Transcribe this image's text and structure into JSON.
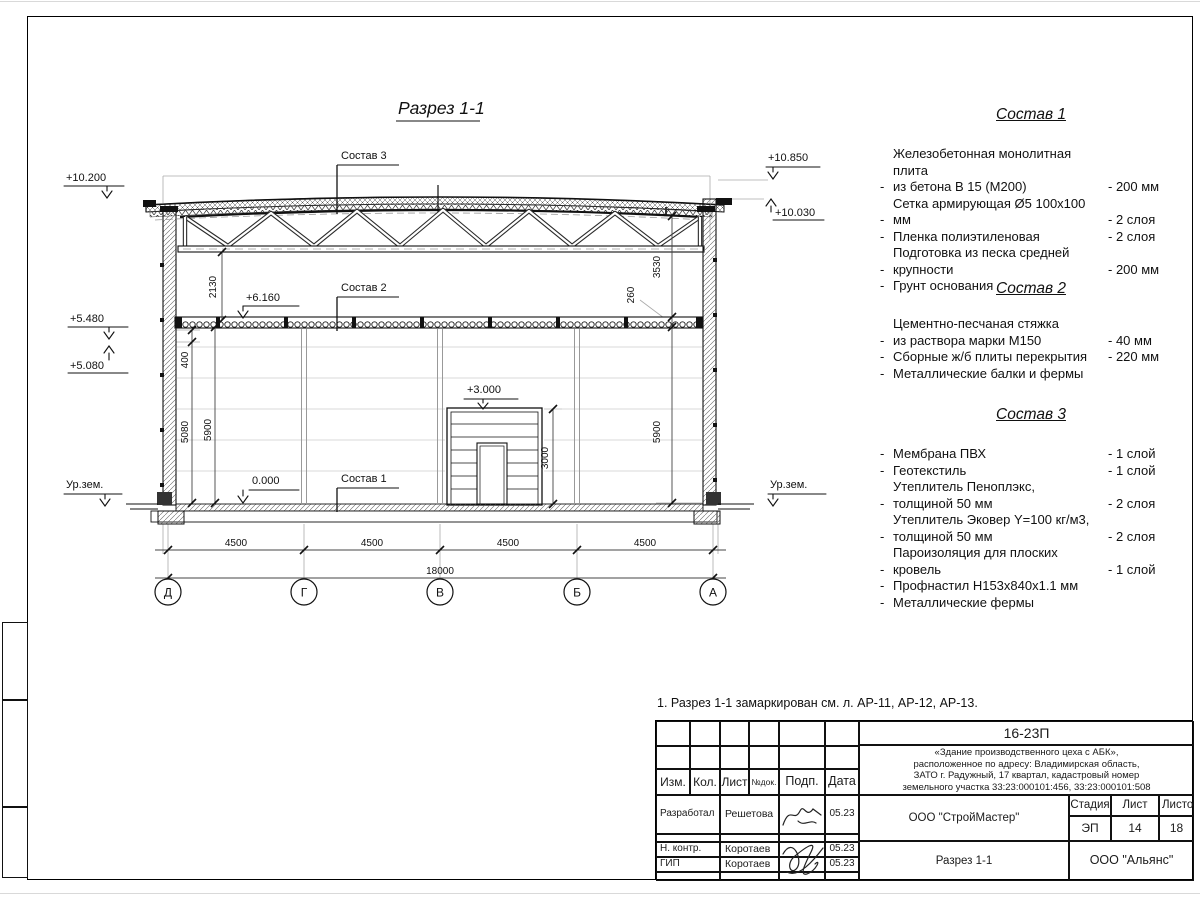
{
  "sheet": {
    "title": "Разрез 1-1",
    "note": "1. Разрез 1-1 замаркирован см. л. АР-11, АР-12, АР-13."
  },
  "drawing": {
    "labels": {
      "sostav1": "Состав 1",
      "sostav2": "Состав 2",
      "sostav3": "Состав 3"
    },
    "elevations": {
      "left_roof": "+10.200",
      "right_parapet": "+10.850",
      "right_roof": "+10.030",
      "left_upper": "+5.480",
      "left_lower": "+5.080",
      "slab": "+6.160",
      "gate": "+3.000",
      "floor": "0.000",
      "ground_left": "Ур.зем.",
      "ground_right": "Ур.зем."
    },
    "dims": {
      "truss_clear": "2130",
      "upper_right": "3530",
      "slab_thick": "260",
      "beam": "400",
      "left_inner": "5080",
      "left_full": "5900",
      "right_full": "5900",
      "gate_h": "3000",
      "spans": [
        "4500",
        "4500",
        "4500",
        "4500"
      ],
      "total": "18000"
    },
    "axes": [
      "Д",
      "Г",
      "В",
      "Б",
      "А"
    ]
  },
  "compositions": {
    "bullet": "-",
    "blocks": [
      {
        "title": "Состав 1",
        "items": [
          {
            "text": "Железобетонная  монолитная плита\nиз бетона В 15 (М200)",
            "value": "- 200 мм"
          },
          {
            "text": "Сетка армирующая Ø5 100x100 мм",
            "value": "- 2 слоя"
          },
          {
            "text": "Пленка полиэтиленовая",
            "value": "-  2 слоя"
          },
          {
            "text": "Подготовка из песка средней\nкрупности",
            "value": "- 200 мм"
          },
          {
            "text": "Грунт основания",
            "value": ""
          }
        ]
      },
      {
        "title": "Состав 2",
        "items": [
          {
            "text": "Цементно-песчаная стяжка\nиз раствора марки М150",
            "value": "- 40 мм"
          },
          {
            "text": "Сборные ж/б плиты перекрытия",
            "value": "- 220 мм"
          },
          {
            "text": "Металлические балки и фермы",
            "value": ""
          }
        ]
      },
      {
        "title": "Состав 3",
        "items": [
          {
            "text": "Мембрана ПВХ",
            "value": "- 1 слой"
          },
          {
            "text": "Геотекстиль",
            "value": "- 1 слой"
          },
          {
            "text": "Утеплитель Пеноплэкс,\nтолщиной 50 мм",
            "value": "- 2 слоя"
          },
          {
            "text": "Утеплитель Эковер Y=100 кг/м3,\nтолщиной 50 мм",
            "value": "- 2 слоя"
          },
          {
            "text": "Пароизоляция для плоских кровель",
            "value": "- 1 слой"
          },
          {
            "text": "Профнастил Н153х840х1.1 мм",
            "value": ""
          },
          {
            "text": "Металлические фермы",
            "value": ""
          }
        ]
      }
    ]
  },
  "titleblock": {
    "doc_number": "16-23П",
    "object_lines": [
      "«Здание производственного цеха с АБК»,",
      "расположенное по адресу: Владимирская область,",
      "ЗАТО г. Радужный, 17 квартал, кадастровый номер",
      "земельного участка 33:23:000101:456, 33:23:000101:508"
    ],
    "contractor": "ООО \"СтройМастер\"",
    "drawing_title": "Разрез 1-1",
    "company": "ООО \"Альянс\"",
    "stage_label": "Стадия",
    "stage": "ЭП",
    "sheet_label": "Лист",
    "sheet": "14",
    "sheets_label": "Листов",
    "sheets": "18",
    "cols": {
      "izm": "Изм.",
      "kol": "Кол.",
      "list": "Лист",
      "doc": "№док.",
      "podp": "Подп.",
      "date": "Дата"
    },
    "rows": [
      {
        "role": "Разработал",
        "name": "Решетова",
        "date": "05.23"
      },
      {
        "role": "Н. контр.",
        "name": "Коротаев",
        "date": "05.23"
      },
      {
        "role": "ГИП",
        "name": "Коротаев",
        "date": "05.23"
      }
    ]
  }
}
